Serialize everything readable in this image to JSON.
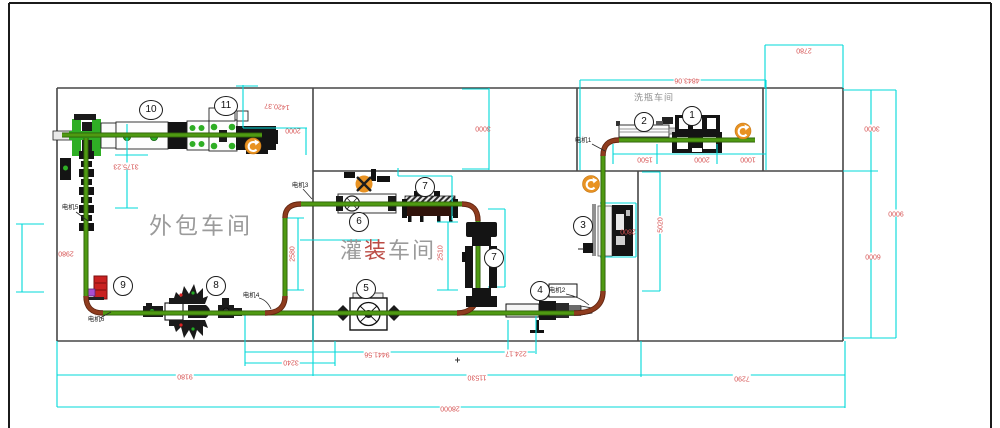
{
  "colors": {
    "wall": "#474747",
    "border": "#1b1b1b",
    "green": "#4f9a12",
    "greendark": "#2e5f08",
    "brown": "#8f3c1e",
    "browndark": "#5f2410",
    "cyan": "#00d9d9",
    "dimred": "#d65252",
    "dark": "#161616",
    "orange": "#e89222",
    "mgreen": "#2fae25",
    "alarm": "#c92121",
    "magenta": "#a94fd1",
    "roomtext": "#9b9b9b",
    "hotred": "#bb4b44",
    "motortext": "#1d1d1d"
  },
  "rooms": [
    {
      "id": "wash-room",
      "x": 654,
      "y": 98,
      "size": 9,
      "ls": 1,
      "segments": [
        {
          "t": "洗瓶车间",
          "c": "#8f8f8f"
        }
      ]
    },
    {
      "id": "pack-room",
      "x": 201,
      "y": 226,
      "size": 23,
      "ls": 3,
      "segments": [
        {
          "t": "外包车间",
          "c": "#9b9b9b"
        }
      ]
    },
    {
      "id": "fill-room",
      "x": 388,
      "y": 251,
      "size": 22,
      "ls": 2,
      "segments": [
        {
          "t": "灌",
          "c": "#9b9b9b"
        },
        {
          "t": "装",
          "c": "#bb4b44"
        },
        {
          "t": "车间",
          "c": "#9b9b9b"
        }
      ]
    }
  ],
  "badges": [
    {
      "n": "1",
      "x": 692,
      "y": 116
    },
    {
      "n": "2",
      "x": 644,
      "y": 122
    },
    {
      "n": "3",
      "x": 583,
      "y": 226
    },
    {
      "n": "4",
      "x": 540,
      "y": 291
    },
    {
      "n": "5",
      "x": 366,
      "y": 289
    },
    {
      "n": "6",
      "x": 359,
      "y": 222
    },
    {
      "n": "7",
      "x": 425,
      "y": 187
    },
    {
      "n": "7",
      "x": 494,
      "y": 258
    },
    {
      "n": "8",
      "x": 216,
      "y": 286
    },
    {
      "n": "9",
      "x": 123,
      "y": 286
    },
    {
      "n": "10",
      "x": 151,
      "y": 110
    },
    {
      "n": "11",
      "x": 226,
      "y": 106
    }
  ],
  "dims": [
    {
      "t": "1420.37",
      "x": 277,
      "y": 106,
      "rot": 184,
      "bg": 0
    },
    {
      "t": "2000",
      "x": 293,
      "y": 130,
      "rot": 180,
      "bg": 0
    },
    {
      "t": "3175.23",
      "x": 126,
      "y": 166,
      "rot": 180,
      "bg": 1
    },
    {
      "t": "2980",
      "x": 66,
      "y": 253,
      "rot": 180,
      "bg": 0
    },
    {
      "t": "2580",
      "x": 293,
      "y": 254,
      "rot": -90,
      "bg": 0
    },
    {
      "t": "2510",
      "x": 441,
      "y": 253,
      "rot": -90,
      "bg": 0
    },
    {
      "t": "3000",
      "x": 483,
      "y": 128,
      "rot": 180,
      "bg": 0
    },
    {
      "t": "4843.06",
      "x": 687,
      "y": 80,
      "rot": 180,
      "bg": 1
    },
    {
      "t": "1500",
      "x": 645,
      "y": 159,
      "rot": 180,
      "bg": 1
    },
    {
      "t": "2000",
      "x": 702,
      "y": 159,
      "rot": 180,
      "bg": 1
    },
    {
      "t": "1000",
      "x": 748,
      "y": 159,
      "rot": 180,
      "bg": 1
    },
    {
      "t": "2780",
      "x": 804,
      "y": 50,
      "rot": 180,
      "bg": 1
    },
    {
      "t": "3000",
      "x": 872,
      "y": 128,
      "rot": 180,
      "bg": 1
    },
    {
      "t": "9000",
      "x": 896,
      "y": 213,
      "rot": 180,
      "bg": 1
    },
    {
      "t": "6000",
      "x": 873,
      "y": 256,
      "rot": 180,
      "bg": 1
    },
    {
      "t": "5020",
      "x": 661,
      "y": 225,
      "rot": -90,
      "bg": 1
    },
    {
      "t": "2800",
      "x": 628,
      "y": 231,
      "rot": 180,
      "bg": 0
    },
    {
      "t": "224.17",
      "x": 516,
      "y": 353,
      "rot": 180,
      "bg": 1
    },
    {
      "t": "9441.56",
      "x": 377,
      "y": 354,
      "rot": 180,
      "bg": 1
    },
    {
      "t": "3240",
      "x": 291,
      "y": 362,
      "rot": 180,
      "bg": 1
    },
    {
      "t": "9180",
      "x": 185,
      "y": 376,
      "rot": 180,
      "bg": 1
    },
    {
      "t": "11530",
      "x": 477,
      "y": 377,
      "rot": 180,
      "bg": 1
    },
    {
      "t": "7290",
      "x": 742,
      "y": 378,
      "rot": 180,
      "bg": 1
    },
    {
      "t": "28000",
      "x": 450,
      "y": 408,
      "rot": 180,
      "bg": 1
    }
  ],
  "motors": [
    {
      "t": "电机1",
      "x": 583,
      "y": 141
    },
    {
      "t": "电机2",
      "x": 557,
      "y": 291
    },
    {
      "t": "电机3",
      "x": 300,
      "y": 186
    },
    {
      "t": "电机4",
      "x": 251,
      "y": 296
    },
    {
      "t": "电机5",
      "x": 70,
      "y": 208
    },
    {
      "t": "电机6",
      "x": 96,
      "y": 320
    }
  ]
}
